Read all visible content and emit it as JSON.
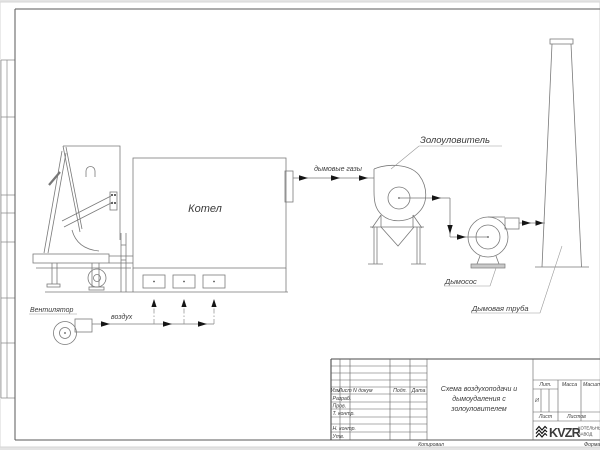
{
  "drawing": {
    "labels": {
      "boiler": "Котел",
      "fan": "Вентилятор",
      "air": "воздух",
      "flue_gases": "дымовые газы",
      "ash_collector": "Золоуловитель",
      "smoke_exhauster": "Дымосос",
      "chimney": "Дымовая труба"
    }
  },
  "title_block": {
    "columns": {
      "izm": "Изм",
      "list": "Лист",
      "doc_num": "N докум",
      "podp": "Подп.",
      "data": "Дата"
    },
    "rows": {
      "razrab": "Разраб.",
      "prov": "Пров.",
      "t_kontr": "Т. контр.",
      "n_kontr": "Н. контр.",
      "utv": "Утв."
    },
    "doc_title_line1": "Схема воздухоподачи и",
    "doc_title_line2": "дымоудаления с",
    "doc_title_line3": "золоуловителем",
    "lit_label": "Лит.",
    "lit_value": "И",
    "massa_label": "Масса",
    "masshtab_label": "Масштаб",
    "list_label": "Лист",
    "listov_label": "Листов",
    "logo": {
      "text": "KVZR",
      "sub_line1": "КОТЕЛЬНЫЙ",
      "sub_line2": "ЗАВОД"
    },
    "kopiroval": "Копировал",
    "format": "Формат"
  }
}
